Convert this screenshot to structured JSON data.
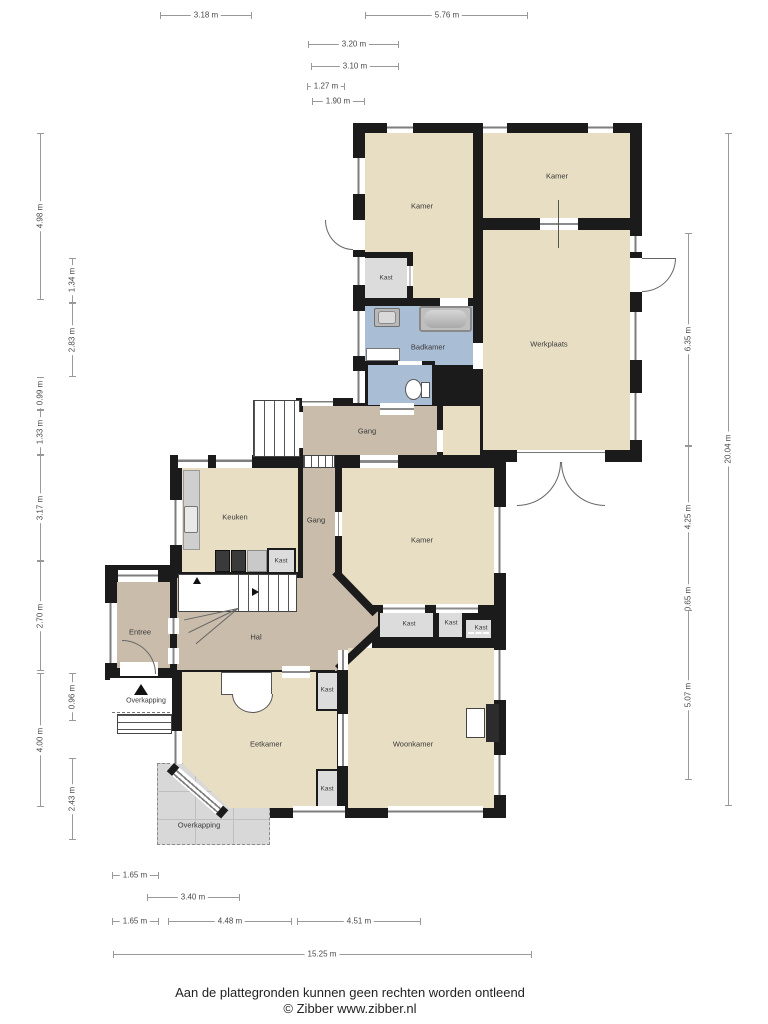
{
  "rooms": [
    {
      "name": "kamer-topleft",
      "label": "Kamer"
    },
    {
      "name": "kamer-topright",
      "label": "Kamer"
    },
    {
      "name": "kast-upper",
      "label": "Kast"
    },
    {
      "name": "badkamer",
      "label": "Badkamer"
    },
    {
      "name": "werkplaats",
      "label": "Werkplaats"
    },
    {
      "name": "gang-boven",
      "label": "Gang"
    },
    {
      "name": "keuken",
      "label": "Keuken"
    },
    {
      "name": "gang",
      "label": "Gang"
    },
    {
      "name": "kamer-midden",
      "label": "Kamer"
    },
    {
      "name": "kast-keuken",
      "label": "Kast"
    },
    {
      "name": "kast-rij-1",
      "label": "Kast"
    },
    {
      "name": "kast-rij-2",
      "label": "Kast"
    },
    {
      "name": "kast-rij-3",
      "label": "Kast"
    },
    {
      "name": "entree",
      "label": "Entree"
    },
    {
      "name": "hal",
      "label": "Hal"
    },
    {
      "name": "kast-hal",
      "label": "Kast"
    },
    {
      "name": "overkapping-klein",
      "label": "Overkapping"
    },
    {
      "name": "eetkamer",
      "label": "Eetkamer"
    },
    {
      "name": "woonkamer",
      "label": "Woonkamer"
    },
    {
      "name": "kast-onder",
      "label": "Kast"
    },
    {
      "name": "overkapping-groot",
      "label": "Overkapping"
    }
  ],
  "dimensions": {
    "top": [
      "3.18 m",
      "5.76 m",
      "3.20 m",
      "3.10 m",
      "1.27 m",
      "1.90 m"
    ],
    "left": [
      "4.98 m",
      "1.34 m",
      "2.83 m",
      "0.99 m",
      "1.33 m",
      "3.17 m",
      "2.70 m",
      "0.96 m",
      "4.00 m",
      "2.43 m"
    ],
    "right": [
      "6.35 m",
      "20.04 m",
      "4.25 m",
      "0.65 m",
      "5.07 m"
    ],
    "bottom": [
      "1.65 m",
      "3.40 m",
      "1.65 m",
      "4.48 m",
      "4.51 m",
      "15.25 m"
    ]
  },
  "footer": {
    "disclaimer": "Aan de plattegronden kunnen geen rechten worden ontleend",
    "copyright": "© Zibber www.zibber.nl"
  },
  "palette": {
    "wall": "#1b1b1b",
    "room_floor": "#e7dec3",
    "hall_floor": "#c9bcab",
    "bathroom_floor": "#a9bdd5",
    "closet_floor": "#dcdcdc",
    "canopy": "#d8d8d8"
  }
}
